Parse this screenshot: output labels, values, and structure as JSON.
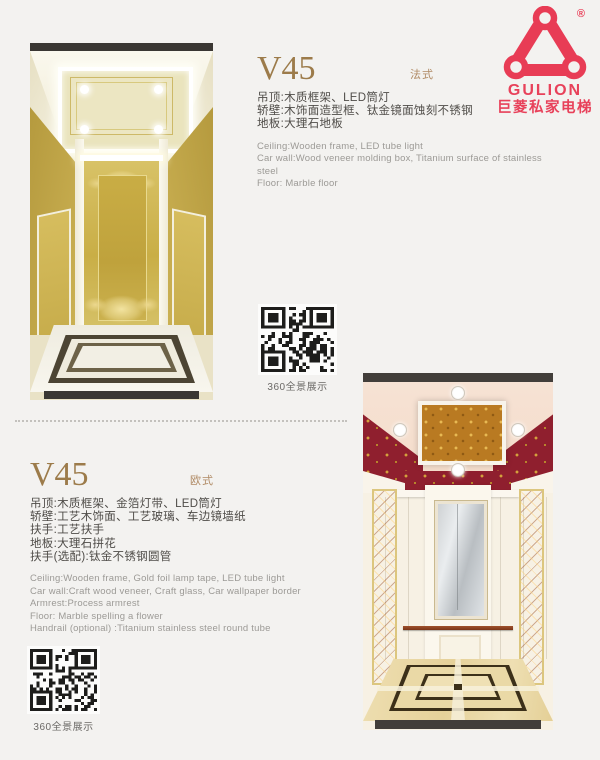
{
  "brand": {
    "wordmark": "GULION",
    "company_cn": "巨菱私家电梯",
    "registered": "®",
    "brand_color": "#e8415a"
  },
  "sections": [
    {
      "model": "V45",
      "style": "法式",
      "specs_cn": [
        "吊顶:木质框架、LED筒灯",
        "轿壁:木饰面造型框、钛金镜面蚀刻不锈钢",
        "地板:大理石地板"
      ],
      "specs_en": [
        "Ceiling:Wooden frame, LED tube light",
        "Car wall:Wood veneer molding box, Titanium surface of stainless steel",
        "Floor: Marble floor"
      ],
      "qr_label": "360全景展示"
    },
    {
      "model": "V45",
      "style": "欧式",
      "specs_cn": [
        "吊顶:木质框架、金箔灯带、LED筒灯",
        "轿壁:工艺木饰面、工艺玻璃、车边镜墙纸",
        "扶手:工艺扶手",
        "地板:大理石拼花",
        "扶手(选配):钛金不锈钢圆管"
      ],
      "specs_en": [
        "Ceiling:Wooden frame, Gold foil lamp tape, LED tube light",
        "Car wall:Craft wood veneer, Craft glass, Car wallpaper border",
        "Armrest:Process armrest",
        "Floor: Marble spelling a flower",
        "Handrail (optional) :Titanium stainless steel round tube"
      ],
      "qr_label": "360全景展示"
    }
  ],
  "colors": {
    "page_bg": "#f3f2f0",
    "model_title": "#9c7b4a",
    "style_tag": "#b08a64",
    "spec_cn_text": "#4f4c48",
    "spec_en_text": "#9c9a96",
    "qr_label_text": "#6b6966",
    "brand_red": "#e8415a"
  }
}
